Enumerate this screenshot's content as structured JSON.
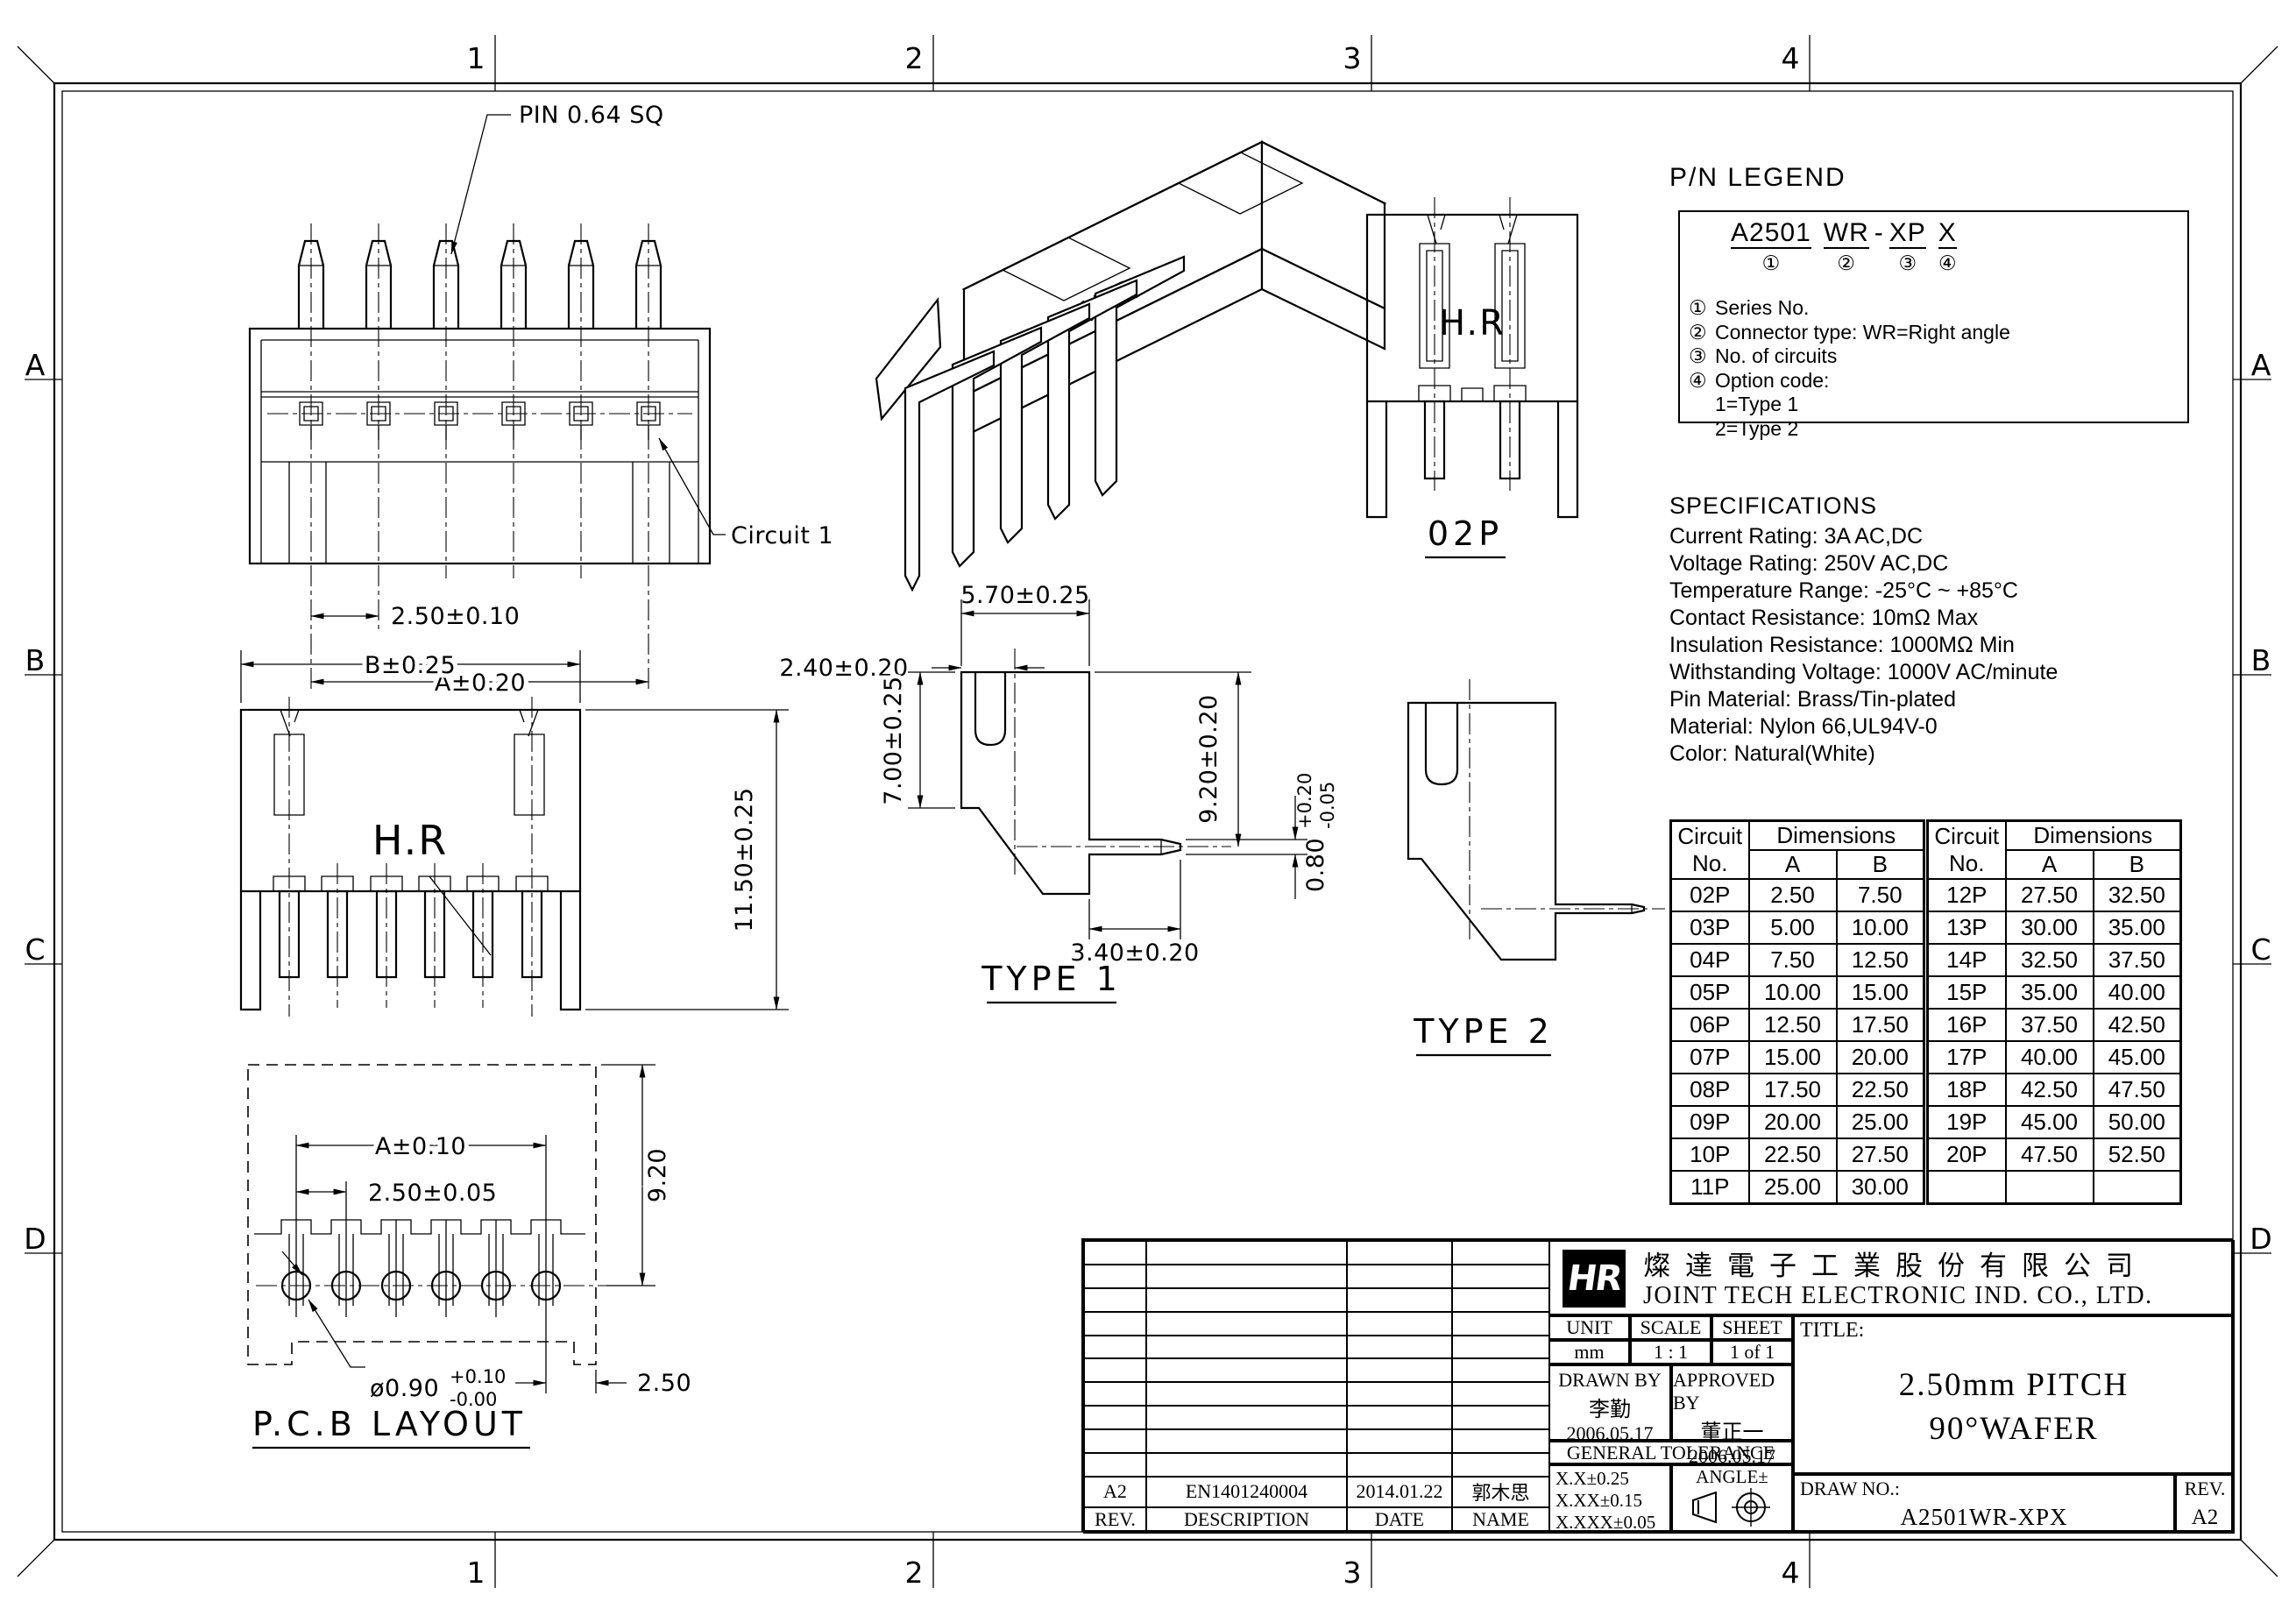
{
  "sheet": {
    "zone_columns": [
      "1",
      "2",
      "3",
      "4"
    ],
    "zone_rows": [
      "A",
      "B",
      "C",
      "D"
    ]
  },
  "views": {
    "top_view": {
      "pin_label": "PIN 0.64 SQ",
      "pitch_dim": "2.50±0.10",
      "overall_dim": "A±0.20",
      "circuit_label": "Circuit 1"
    },
    "front_view": {
      "width_dim": "B±0.25",
      "height_dim": "11.50±0.25",
      "marking": "H.R"
    },
    "iso_view": {
      "marking": "H.R"
    },
    "view_02p": {
      "label": "02P",
      "marking": "H.R"
    },
    "type1": {
      "label": "TYPE 1",
      "dim_top_width": "5.70±0.25",
      "dim_edge_offset": "2.40±0.20",
      "dim_left_height": "7.00±0.25",
      "dim_right_height": "9.20±0.20",
      "dim_pin_thickness": "0.80",
      "pin_tol_plus": "+0.20",
      "pin_tol_minus": "-0.05",
      "dim_pin_length": "3.40±0.20"
    },
    "type2": {
      "label": "TYPE 2"
    },
    "pcb_layout": {
      "label": "P.C.B LAYOUT",
      "overall_dim": "A±0.10",
      "pitch_dim": "2.50±0.05",
      "height_dim": "9.20",
      "hole_dim": "ø0.90",
      "hole_tol_plus": "+0.10",
      "hole_tol_minus": "-0.00",
      "edge_dim": "2.50"
    }
  },
  "pn_legend": {
    "title": "P/N LEGEND",
    "part_segments": [
      {
        "text": "A2501",
        "marker": "①"
      },
      {
        "text": "WR",
        "marker": "②"
      },
      {
        "text": "-",
        "marker": ""
      },
      {
        "text": "XP",
        "marker": "③"
      },
      {
        "text": "X",
        "marker": "④"
      }
    ],
    "items": [
      {
        "num": "①",
        "text": "Series No."
      },
      {
        "num": "②",
        "text": "Connector type: WR=Right angle"
      },
      {
        "num": "③",
        "text": "No. of circuits"
      },
      {
        "num": "④",
        "text": "Option code:"
      },
      {
        "num": "",
        "text": "1=Type 1"
      },
      {
        "num": "",
        "text": "2=Type 2"
      }
    ]
  },
  "specifications": {
    "title": "SPECIFICATIONS",
    "lines": [
      "Current Rating: 3A AC,DC",
      "Voltage Rating: 250V AC,DC",
      "Temperature Range: -25°C ~ +85°C",
      "Contact Resistance: 10mΩ Max",
      "Insulation Resistance: 1000MΩ Min",
      "Withstanding Voltage: 1000V AC/minute",
      "Pin Material: Brass/Tin-plated",
      "Material: Nylon 66,UL94V-0",
      "Color: Natural(White)"
    ]
  },
  "circuit_table": {
    "header": {
      "circuit": "Circuit",
      "no": "No.",
      "dimensions": "Dimensions",
      "a": "A",
      "b": "B"
    },
    "left_rows": [
      [
        "02P",
        "2.50",
        "7.50"
      ],
      [
        "03P",
        "5.00",
        "10.00"
      ],
      [
        "04P",
        "7.50",
        "12.50"
      ],
      [
        "05P",
        "10.00",
        "15.00"
      ],
      [
        "06P",
        "12.50",
        "17.50"
      ],
      [
        "07P",
        "15.00",
        "20.00"
      ],
      [
        "08P",
        "17.50",
        "22.50"
      ],
      [
        "09P",
        "20.00",
        "25.00"
      ],
      [
        "10P",
        "22.50",
        "27.50"
      ],
      [
        "11P",
        "25.00",
        "30.00"
      ]
    ],
    "right_rows": [
      [
        "12P",
        "27.50",
        "32.50"
      ],
      [
        "13P",
        "30.00",
        "35.00"
      ],
      [
        "14P",
        "32.50",
        "37.50"
      ],
      [
        "15P",
        "35.00",
        "40.00"
      ],
      [
        "16P",
        "37.50",
        "42.50"
      ],
      [
        "17P",
        "40.00",
        "45.00"
      ],
      [
        "18P",
        "42.50",
        "47.50"
      ],
      [
        "19P",
        "45.00",
        "50.00"
      ],
      [
        "20P",
        "47.50",
        "52.50"
      ],
      [
        "",
        "",
        ""
      ]
    ]
  },
  "title_block": {
    "company_cn": "燦達電子工業股份有限公司",
    "company_en": "JOINT TECH ELECTRONIC IND. CO., LTD.",
    "logo_text": "HR",
    "unit_label": "UNIT",
    "scale_label": "SCALE",
    "sheet_label": "SHEET",
    "unit_value": "mm",
    "scale_value": "1 : 1",
    "sheet_value": "1 of 1",
    "drawn_by_label": "DRAWN BY",
    "drawn_by_name": "李勤",
    "drawn_by_date": "2006.05.17",
    "approved_by_label": "APPROVED BY",
    "approved_by_name": "董正一",
    "approved_by_date": "2006.05.17",
    "general_tolerance_label": "GENERAL TOLERANCE",
    "tolerances": [
      "X.X±0.25",
      "X.XX±0.15",
      "X.XXX±0.05"
    ],
    "angle_label": "ANGLE±",
    "title_label": "TITLE:",
    "title_line1": "2.50mm PITCH",
    "title_line2": "90°WAFER",
    "draw_no_label": "DRAW NO.:",
    "draw_no_value": "A2501WR-XPX",
    "rev_label": "REV.",
    "rev_value": "A2",
    "revision_row": {
      "rev": "A2",
      "description": "EN1401240004",
      "date": "2014.01.22",
      "name": "郭木思"
    },
    "revision_headers": [
      "REV.",
      "DESCRIPTION",
      "DATE",
      "NAME"
    ]
  }
}
